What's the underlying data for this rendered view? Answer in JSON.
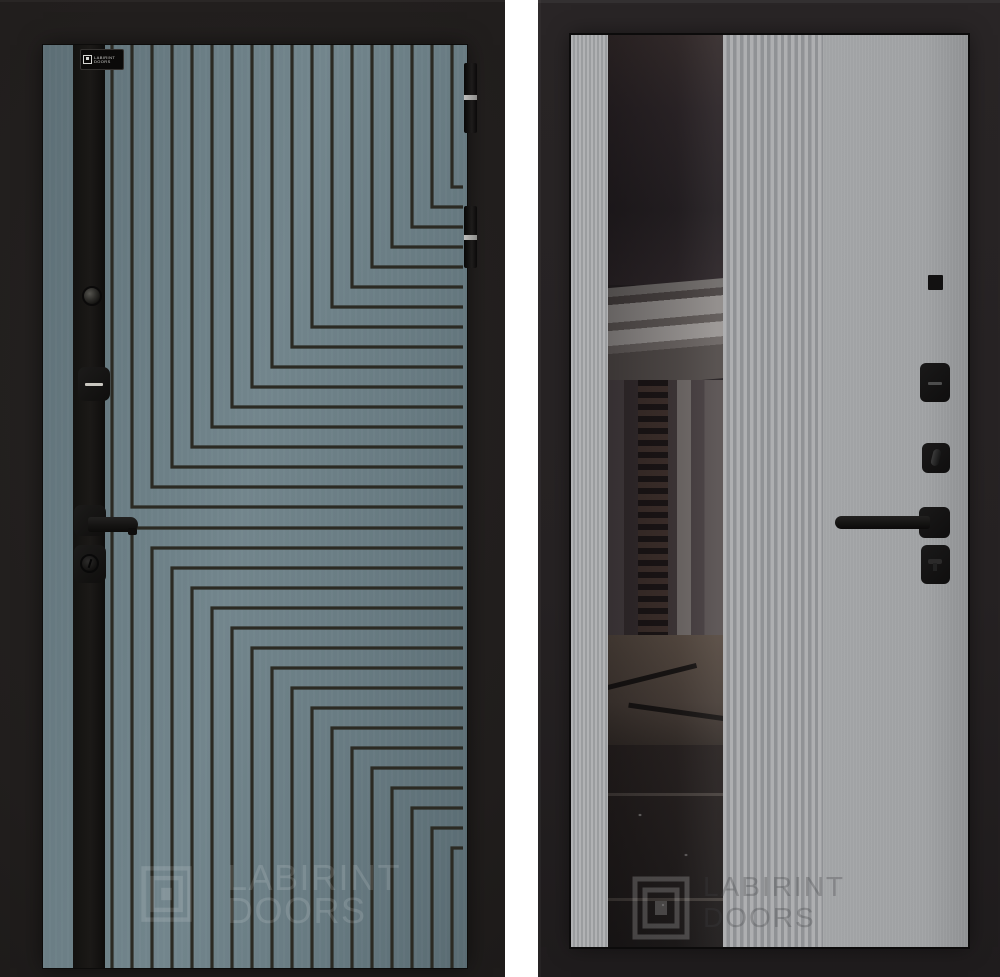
{
  "brand": {
    "name": "LABIRINT",
    "sub": "DOORS"
  },
  "left_door": {
    "side": "exterior",
    "logo_plate": {
      "line1": "LABIRINT",
      "line2": "DOORS"
    },
    "watermark": {
      "line1": "LABIRINT",
      "line2": "DOORS"
    },
    "colors": {
      "panel": "#6b7e85",
      "groove_line": "#2b2a23",
      "strip": "#15130f",
      "background": "#211e1d",
      "hardware": "#141312"
    },
    "pattern": {
      "lines_per_half": 17,
      "spacing": 20,
      "line_width": 3.2,
      "inner_x": 409,
      "inner_y_top": 142,
      "inner_y_bottom": 803,
      "right_edge": 420,
      "height": 923,
      "full_vertical_x": 69
    }
  },
  "right_door": {
    "side": "interior",
    "watermark": {
      "line1": "LABIRINT",
      "line2": "DOORS"
    },
    "colors": {
      "panel": "#a0a2a4",
      "ribbed_light": "#aeafb1",
      "ribbed_dark": "#909295",
      "mirror_tint": "#241f21",
      "background": "#262223",
      "hardware": "#141312"
    }
  }
}
